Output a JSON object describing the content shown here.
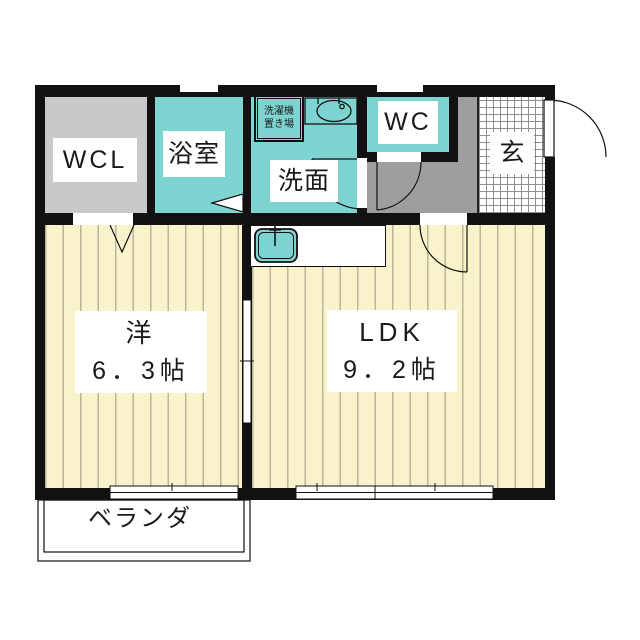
{
  "floorplan": {
    "rooms": {
      "wcl": {
        "label": "WCL"
      },
      "bathroom": {
        "label": "浴室"
      },
      "washroom": {
        "label": "洗面"
      },
      "laundry": {
        "line1": "洗濯機",
        "line2": "置き場"
      },
      "wc": {
        "label": "WC"
      },
      "entrance": {
        "label": "玄"
      },
      "western": {
        "name": "洋",
        "size": "6．3帖"
      },
      "ldk": {
        "name": "LDK",
        "size": "9．2帖"
      },
      "veranda": {
        "label": "ベランダ"
      }
    }
  },
  "colors": {
    "wall": "#111111",
    "wet": "#7ed4d0",
    "closet": "#c9c9c9",
    "hall": "#9e9e9e",
    "floorbg": "#f8f3cb",
    "stripe": "#bab69c"
  }
}
